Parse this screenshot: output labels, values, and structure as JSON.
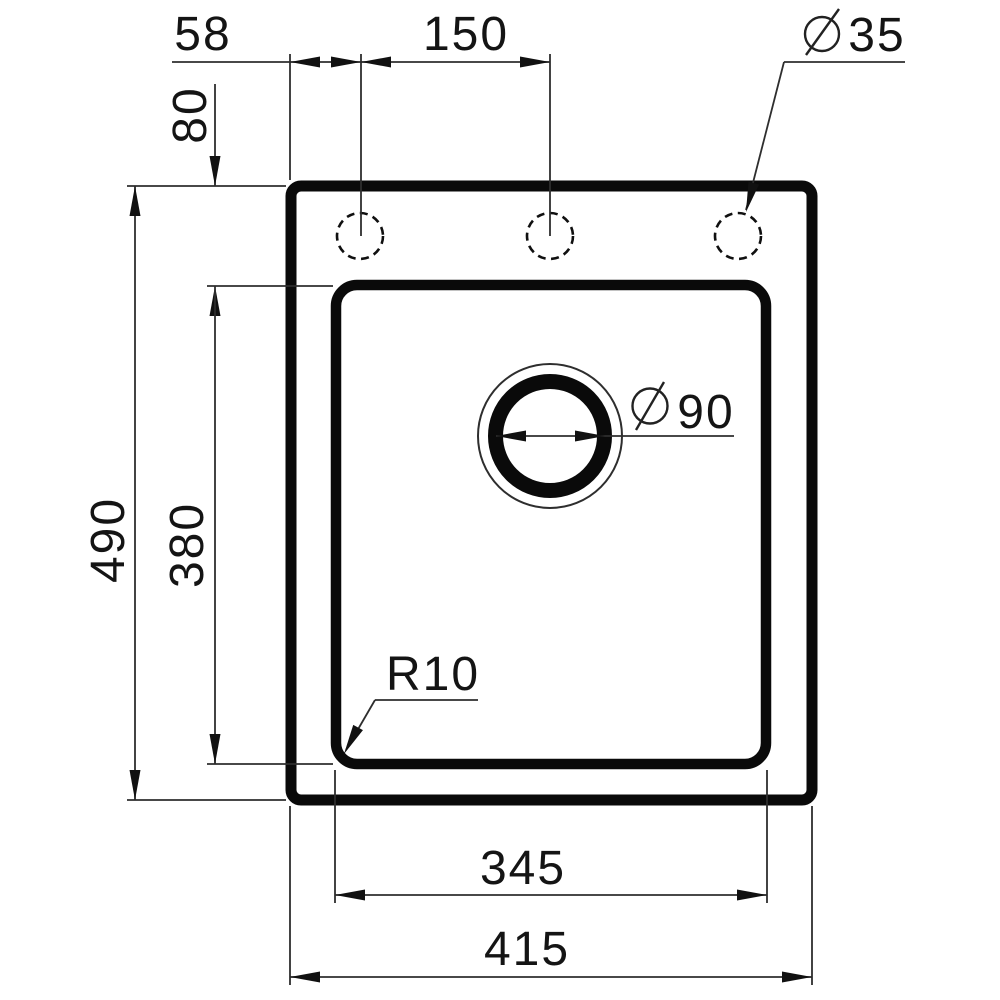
{
  "figure": {
    "type": "technical-drawing",
    "subject": "sink-top-view",
    "faucet_hole_count": 3,
    "colors": {
      "line": "#000000",
      "background": "#ffffff"
    }
  },
  "labels": {
    "hole_offset": "58",
    "hole_spacing": "150",
    "faucet_hole_diameter": "35",
    "top_inset": "80",
    "overall_height": "490",
    "bowl_height": "380",
    "drain_diameter": "90",
    "corner_radius": "R10",
    "bowl_width": "345",
    "overall_width": "415",
    "diameter_symbol": "∅"
  }
}
